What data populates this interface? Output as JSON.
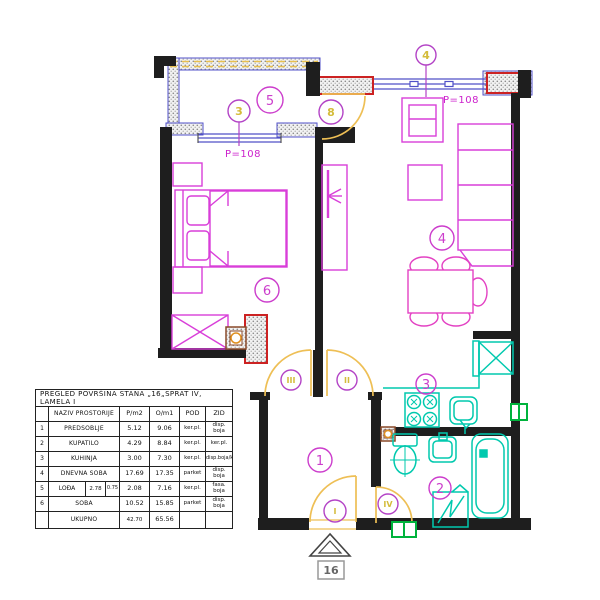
{
  "plan": {
    "apartment_number": "16",
    "parapet_left": "P=108",
    "parapet_top": "P=108",
    "room_marks": {
      "hall": "1",
      "bathroom": "2",
      "kitchen": "3",
      "living_room": "4",
      "loggia": "5",
      "bedroom": "6"
    },
    "opening_marks": {
      "bedroom_window": "3",
      "living_window": "4",
      "loggia_door": "8",
      "entrance_door": "I",
      "living_door": "II",
      "bedroom_door": "III",
      "bathroom_door": "IV"
    },
    "colors": {
      "furniture": "#d93fd9",
      "fixtures": "#00c9ae",
      "doors": "#eebf55",
      "windows": "#5050c8",
      "radiator": "#cc2222",
      "vent": "#00b33c",
      "mark_circle": "#b343c6",
      "mark_text": "#d4bc3a",
      "walls": "#1e1e1e"
    }
  },
  "table": {
    "title": "PREGLED POVRŠINA STANA „16„SPRAT IV, LAMELA I",
    "headers": {
      "naziv": "NAZIV PROSTORIJE",
      "p": "P/m2",
      "o": "O/m1",
      "pod": "POD",
      "zid": "ZID"
    },
    "rows": [
      {
        "num": "1",
        "naziv": "PREDSOBLJE",
        "p": "5.12",
        "o": "9.06",
        "pod": "ker.pl.",
        "zid": "disp. boja"
      },
      {
        "num": "2",
        "naziv": "KUPATILO",
        "p": "4.29",
        "o": "8.84",
        "pod": "ker.pl.",
        "zid": "ker.pl."
      },
      {
        "num": "3",
        "naziv": "KUHINJA",
        "p": "3.00",
        "o": "7.30",
        "pod": "ker.pl.",
        "zid": "disp.boja/ker.pl."
      },
      {
        "num": "4",
        "naziv": "DNEVNA SOBA",
        "p": "17.69",
        "o": "17.35",
        "pod": "parket",
        "zid": "disp. boja"
      },
      {
        "num": "5",
        "naziv": "LOĐA",
        "loda_w": "2.78",
        "loda_k": "0.75",
        "p": "2.08",
        "o": "7.16",
        "pod": "ker.pl.",
        "zid": "fasa. boja"
      },
      {
        "num": "6",
        "naziv": "SOBA",
        "p": "10.52",
        "o": "15.85",
        "pod": "parket",
        "zid": "disp. boja"
      }
    ],
    "total": {
      "label": "UKUPNO",
      "p": "42.70",
      "o": "65.56"
    }
  }
}
